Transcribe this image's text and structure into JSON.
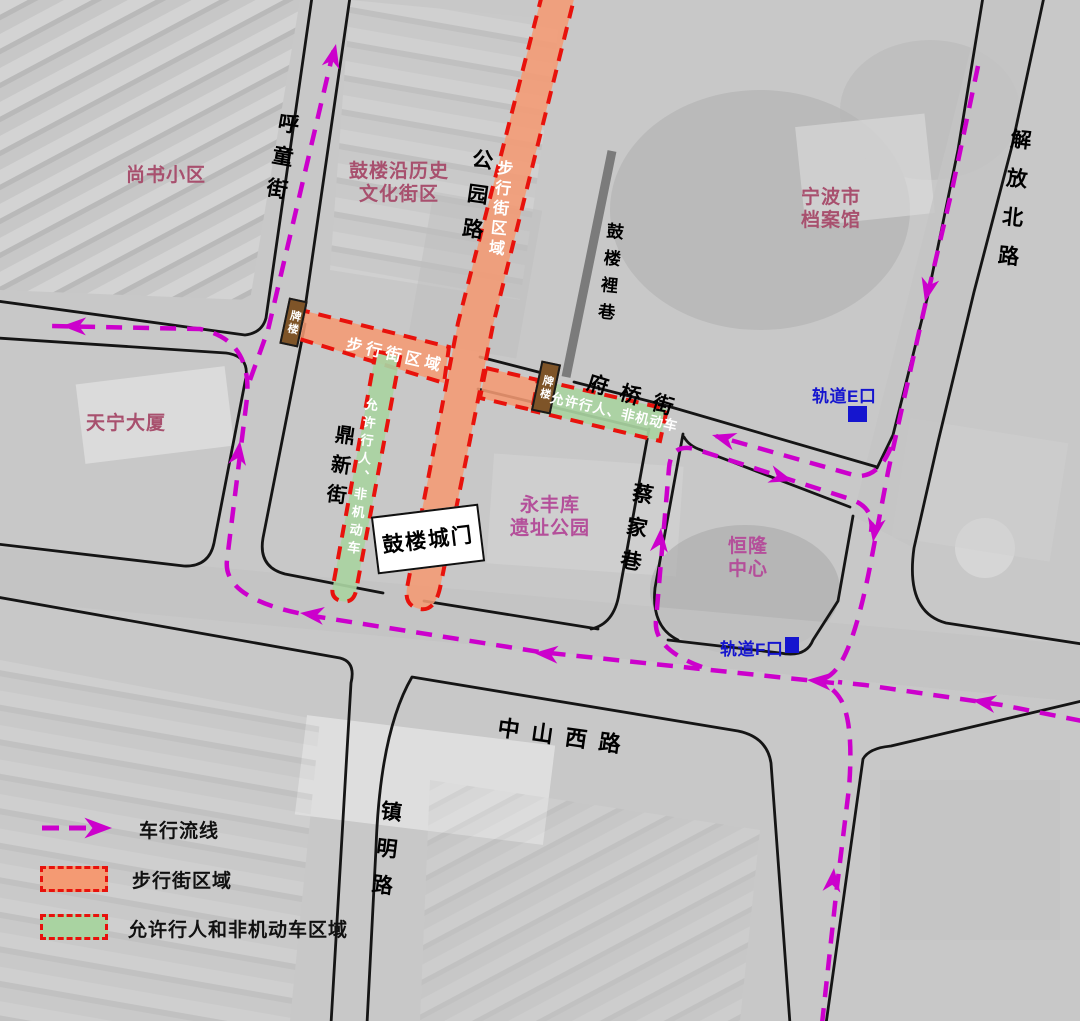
{
  "colors": {
    "flow": "#CC00CC",
    "zone_border": "#E8120C",
    "pedestrian_fill": "#F49A73",
    "mixed_fill": "#A9D3A1",
    "area_label": "#A8506E",
    "poi_label": "#B44F9A",
    "metro": "#1515CF",
    "pailou_fill": "#7E5428",
    "road_line": "#151515",
    "gray_lane": "#7B7B7B"
  },
  "roads": {
    "hutongjie": "呼童街",
    "gongyuanlu": "公园路",
    "fuqiaojie": "府桥街",
    "jiefangbeilu": "解放北路",
    "zhongshanxilu": "中山西路",
    "zhenminglu": "镇明路",
    "caijiaxiang": "蔡家巷",
    "dingxinjie": "鼎新街",
    "guloulixiang": "鼓楼裡巷"
  },
  "areas": {
    "shangshu": "尚书小区",
    "gulou_line1": "鼓楼沿历史",
    "gulou_line2": "文化街区",
    "archive_line1": "宁波市",
    "archive_line2": "档案馆",
    "tianning": "天宁大厦",
    "yongfeng_line1": "永丰库",
    "yongfeng_line2": "遗址公园",
    "henglong_line1": "恒隆",
    "henglong_line2": "中心"
  },
  "markers": {
    "pailou": "牌楼",
    "gate": "鼓楼城门",
    "metro_e": "轨道E口",
    "metro_f": "轨道F口"
  },
  "zones": {
    "pedestrian_label": "步行街区域",
    "mixed_label": "允许行人、非机动车"
  },
  "legend": {
    "flow": "车行流线",
    "pedestrian": "步行街区域",
    "mixed": "允许行人和非机动车区域"
  }
}
